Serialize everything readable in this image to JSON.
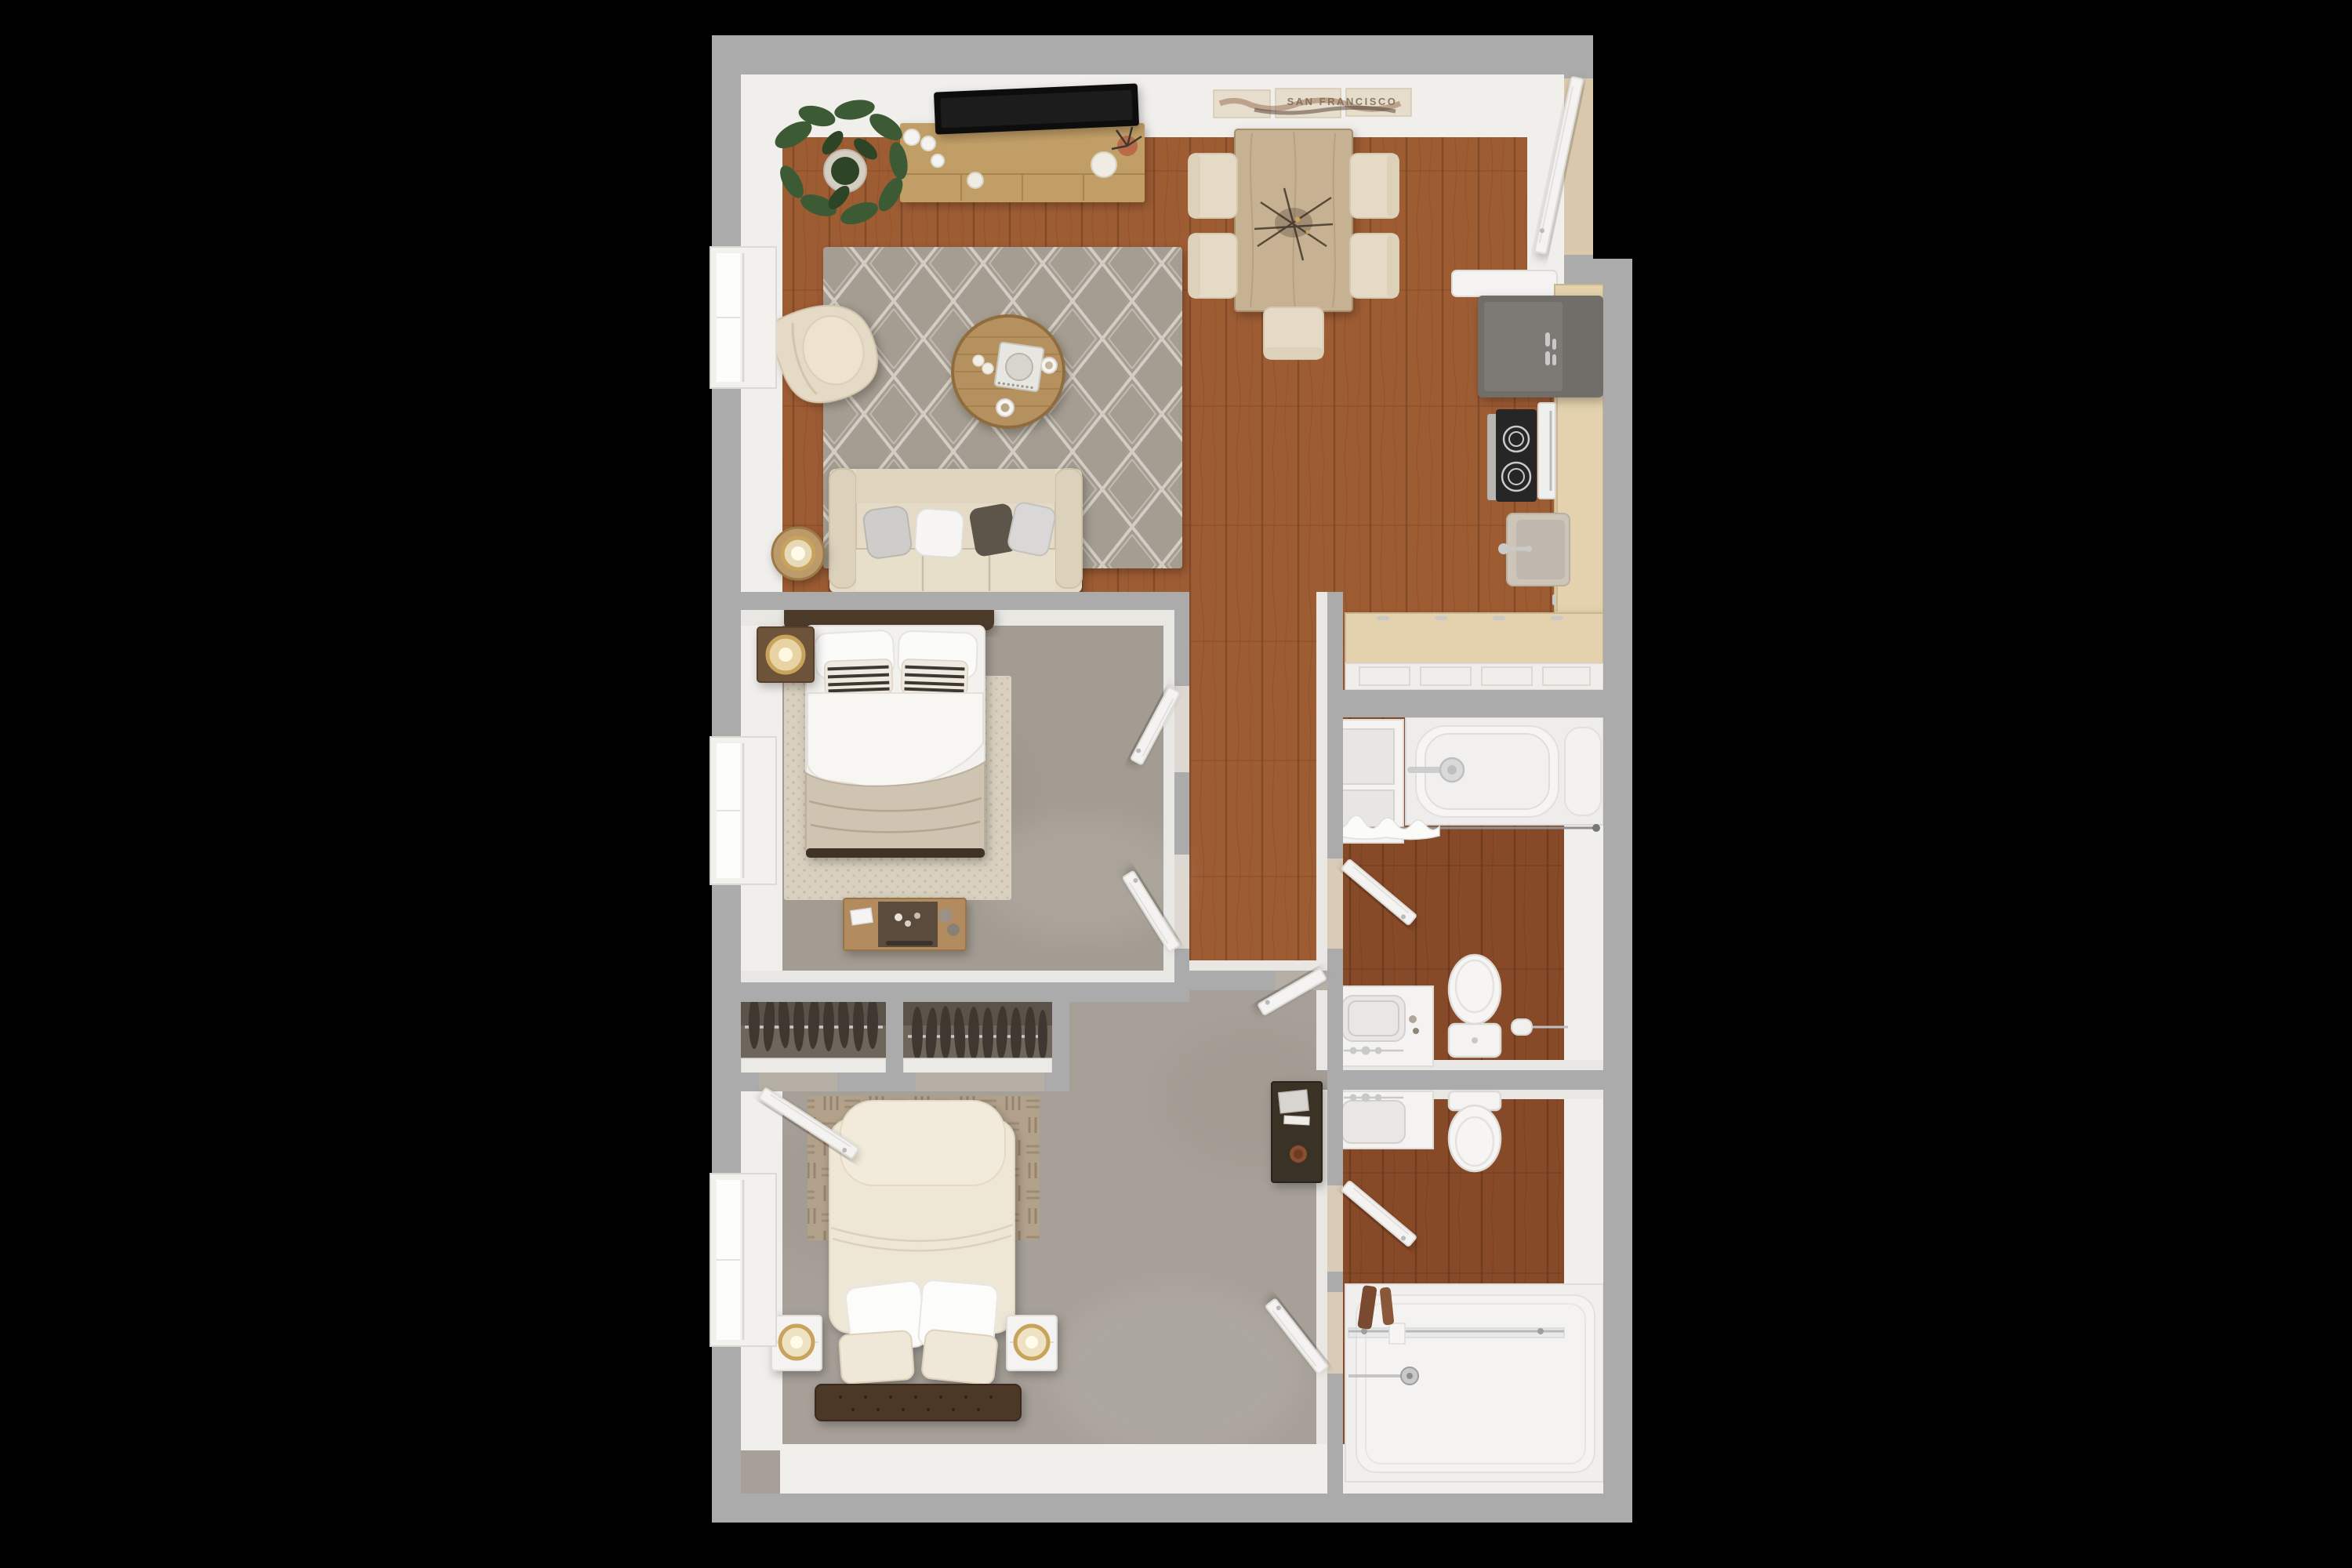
{
  "scene": {
    "type": "3d-floor-plan-render",
    "description": "Top-down 3D rendering of a two-bedroom, two-bathroom apartment floor plan on a black background",
    "background": "#000000"
  },
  "wall_art": {
    "text": "SAN FRANCISCO",
    "panels": 3
  },
  "colors": {
    "wall": "#ababab",
    "wallFace": "#f1efec",
    "wallFace2": "#e9e7e3",
    "woodLiving": "#9e5c33",
    "woodGrain": "#6f3d1e",
    "woodBath": "#874a28",
    "woodBathGrain": "#5e2f16",
    "carpet1": "#a39c92",
    "carpet2": "#a6a098",
    "rugLattice": "#a59d91",
    "rugLatticeLine": "#d9d4ca",
    "rugWoven": "#d9d0bf",
    "rugWovenDot": "#c2b6a0",
    "rugBasket": "#b2a18b",
    "rugBasketLine": "#8d7a63",
    "cream": "#e4dac6",
    "creamDark": "#d5c8ae",
    "fixWhite": "#f4f3f1",
    "fixLine": "#dedcd7",
    "darkWood": "#4e3b2b",
    "bench": "#4b3828",
    "duvet": "#efe7d6",
    "blanket": "#cfc4b2",
    "consoleWood": "#c19e66",
    "tableWood": "#c6b193",
    "counterWood": "#e3d2ad",
    "fridge": "#716d69",
    "cooktop": "#262626",
    "chrome": "#c9c9c9",
    "plant": "#3c5a33",
    "plantDark": "#2d4526",
    "terracotta": "#b96a4a",
    "brass": "#c8a35c",
    "closet": "#6f665b",
    "hanger": "#3f3831",
    "artTan": "#e7ddcc",
    "artText": "#7d6a52"
  },
  "rooms": [
    {
      "name": "living-room",
      "furniture": [
        "tv-console",
        "tv",
        "potted-plant",
        "diamond-lattice-rug",
        "round-coffee-table",
        "serving-tray",
        "accent-chair",
        "sofa",
        "throw-pillows",
        "side-table",
        "ring-lamp",
        "window"
      ]
    },
    {
      "name": "dining-area",
      "furniture": [
        "wood-dining-table",
        "five-cream-chairs",
        "twig-centerpiece",
        "san-francisco-wall-art",
        "entry-door"
      ]
    },
    {
      "name": "kitchen",
      "furniture": [
        "refrigerator",
        "cooktop-range",
        "sink",
        "wall-counter",
        "peninsula-counter",
        "cabinets"
      ]
    },
    {
      "name": "hallway",
      "furniture": [
        "doors-to-bedroom-1",
        "door-to-bathroom-1",
        "door-to-rear-vestibule"
      ]
    },
    {
      "name": "bedroom-1",
      "furniture": [
        "bed-with-headboard",
        "striped-pillows",
        "woven-rug",
        "nightstand",
        "ring-lamp",
        "dresser-with-decor",
        "window"
      ]
    },
    {
      "name": "closets",
      "furniture": [
        "hanging-rod-left",
        "hangers-left",
        "hanging-rod-right",
        "hangers-right"
      ]
    },
    {
      "name": "bathroom-1",
      "furniture": [
        "bathtub",
        "shower-curtain-rod",
        "linen-shelves",
        "vanity-sink",
        "toilet",
        "paper-holder",
        "door"
      ]
    },
    {
      "name": "bedroom-2",
      "furniture": [
        "bed-with-duvet",
        "pillows",
        "tufted-bench",
        "basket-weave-rug",
        "two-white-nightstands",
        "ring-lamps",
        "dark-desk-with-books",
        "closet-door",
        "door",
        "window"
      ]
    },
    {
      "name": "bathroom-2",
      "furniture": [
        "vanity-sink",
        "toilet",
        "walk-in-shower",
        "glass-panel",
        "shower-valve",
        "towels",
        "door"
      ]
    }
  ]
}
